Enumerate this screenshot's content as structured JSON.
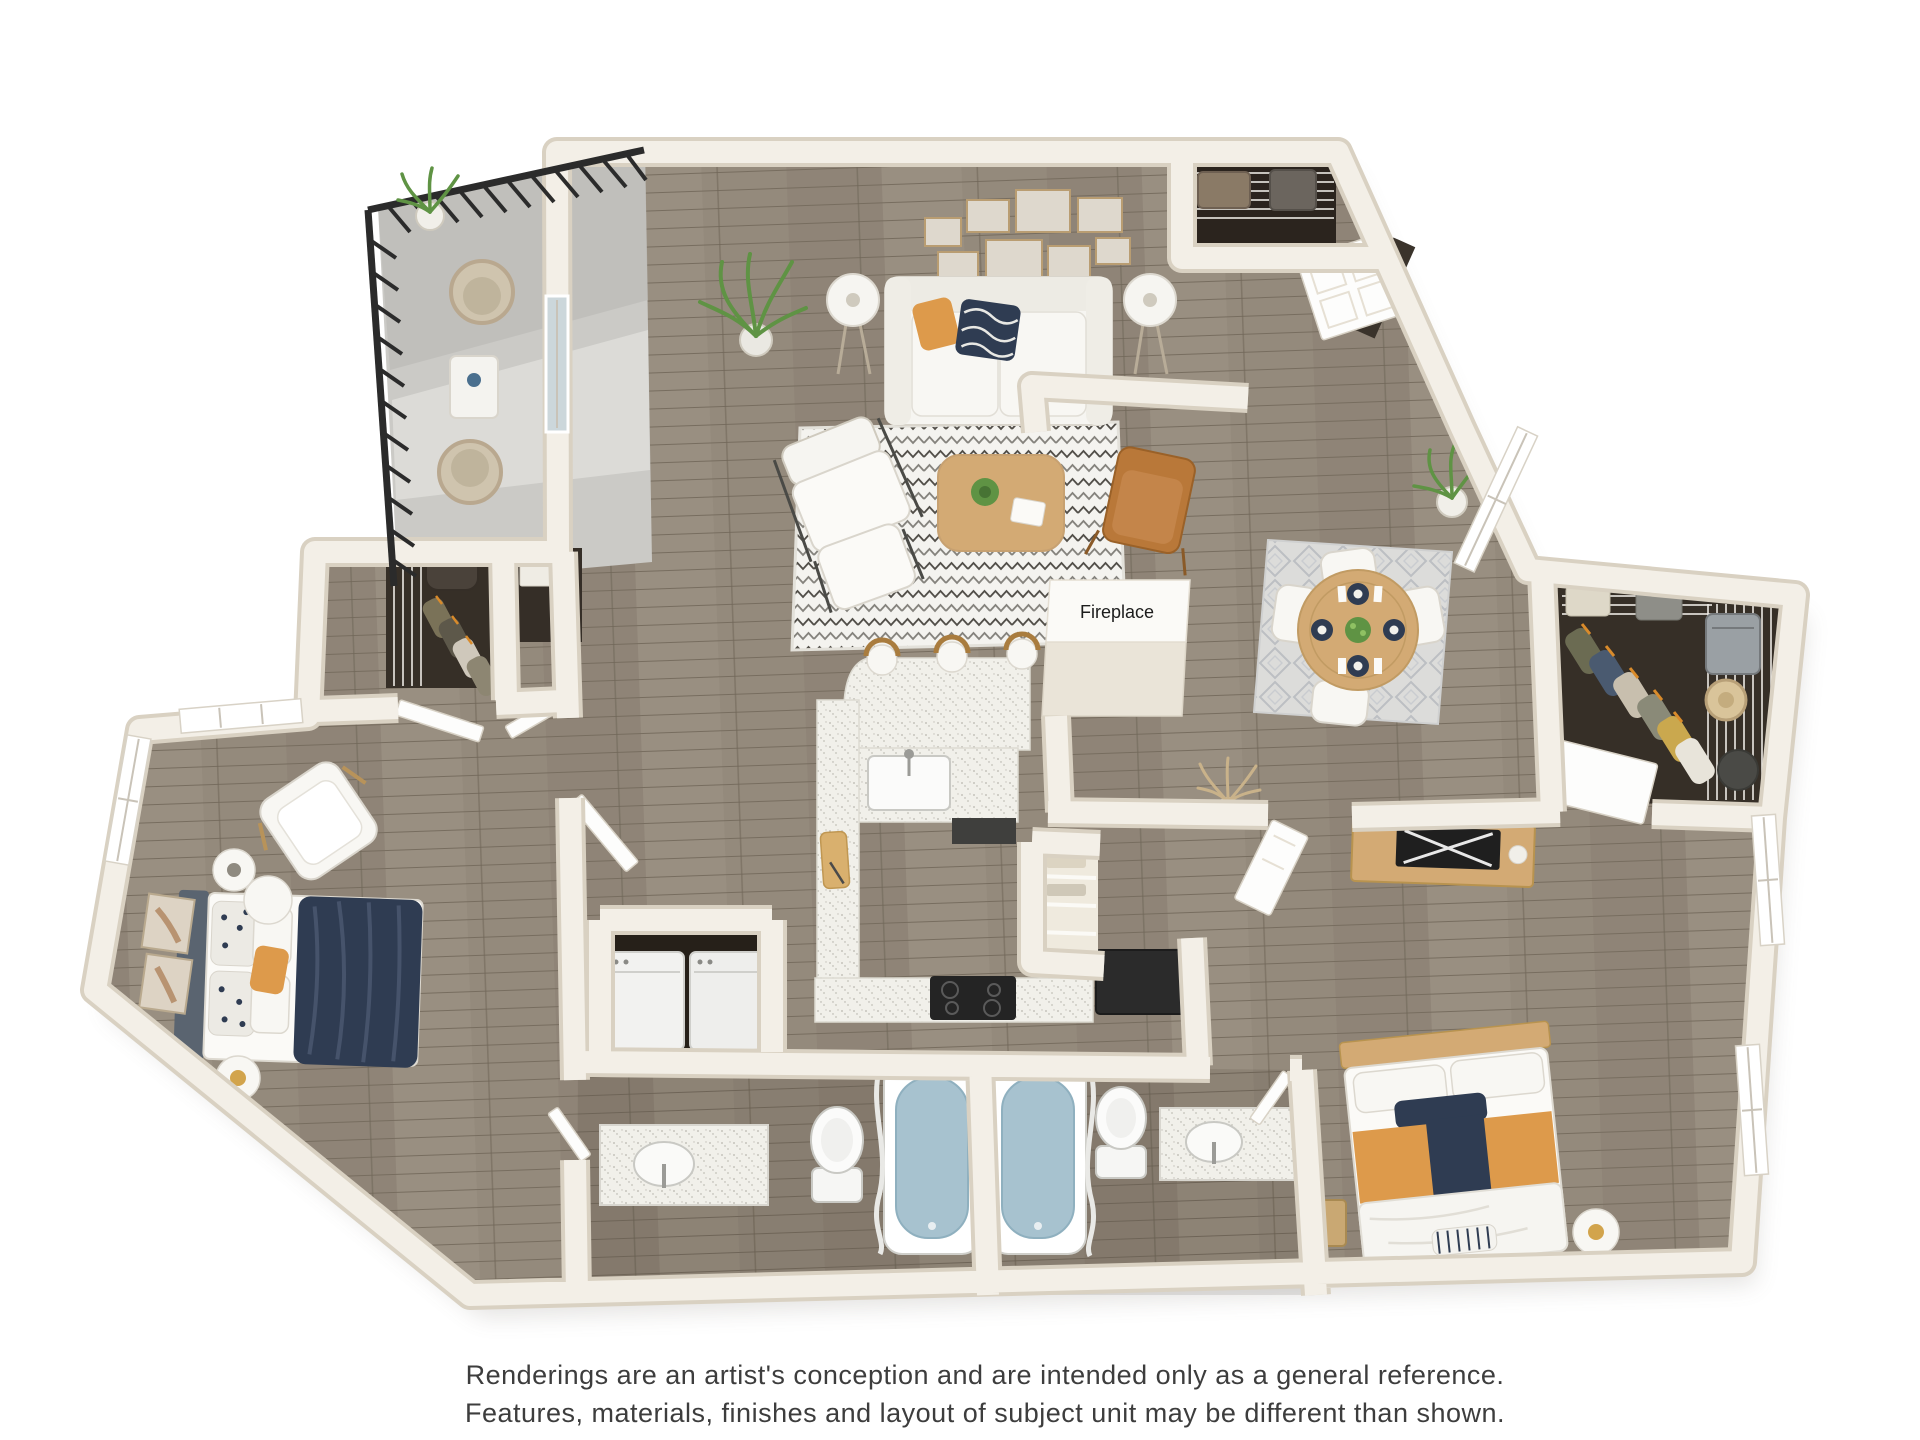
{
  "labels": {
    "fireplace": "Fireplace"
  },
  "disclaimer": {
    "line1": "Renderings are an artist's conception and are intended only as a general reference.",
    "line2": "Features, materials, finishes and layout of subject unit may be different than shown."
  },
  "palette": {
    "background": "#ffffff",
    "wall": "#f3efe7",
    "wall_edge": "#d9d1c2",
    "wood_floor": "#948a7c",
    "balcony_floor": "#cbcac6",
    "closet_floor": "#362f27",
    "counter": "#f1f0ea",
    "tub_water": "#a7c2cf",
    "accent_orange": "#dd9a4b",
    "navy": "#2f3c52",
    "leather": "#b97839",
    "wood_furniture": "#d3aa74",
    "plant_green": "#5f9344",
    "appliance_dark": "#262626",
    "railing": "#2b2b2b",
    "text": "#3d3d3d"
  }
}
